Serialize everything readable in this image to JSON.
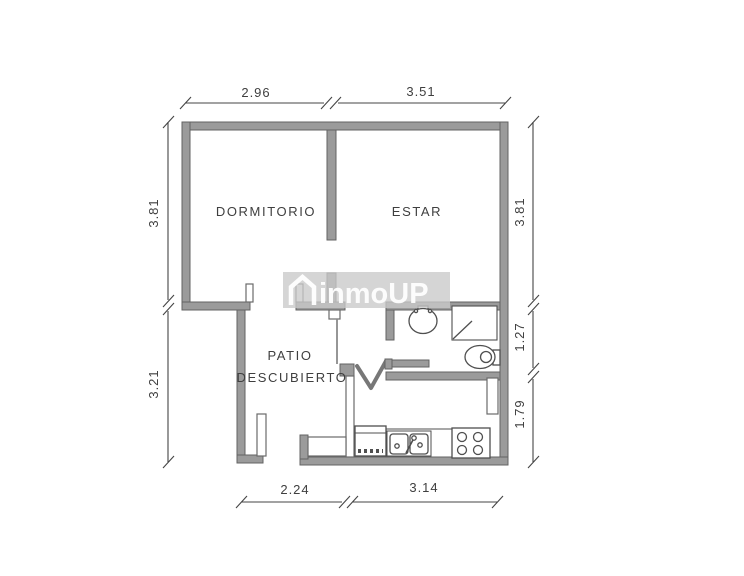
{
  "plan": {
    "watermark": {
      "text": "inmoUP"
    },
    "rooms": {
      "bedroom": "DORMITORIO",
      "living": "ESTAR",
      "patio_line1": "PATIO",
      "patio_line2": "DESCUBIERTO"
    },
    "dimensions": {
      "top": [
        "2.96",
        "3.51"
      ],
      "bottom": [
        "2.24",
        "3.14"
      ],
      "left": [
        "3.81",
        "3.21"
      ],
      "right": [
        "3.81",
        "1.27",
        "1.79"
      ]
    },
    "colors": {
      "wall_fill": "#9b9b9b",
      "wall_stroke": "#636363",
      "dimension_line": "#454545",
      "label_text": "#3f3f3f",
      "watermark_bg": "#c9c9c9",
      "watermark_text": "#ffffff",
      "background": "#ffffff"
    }
  }
}
